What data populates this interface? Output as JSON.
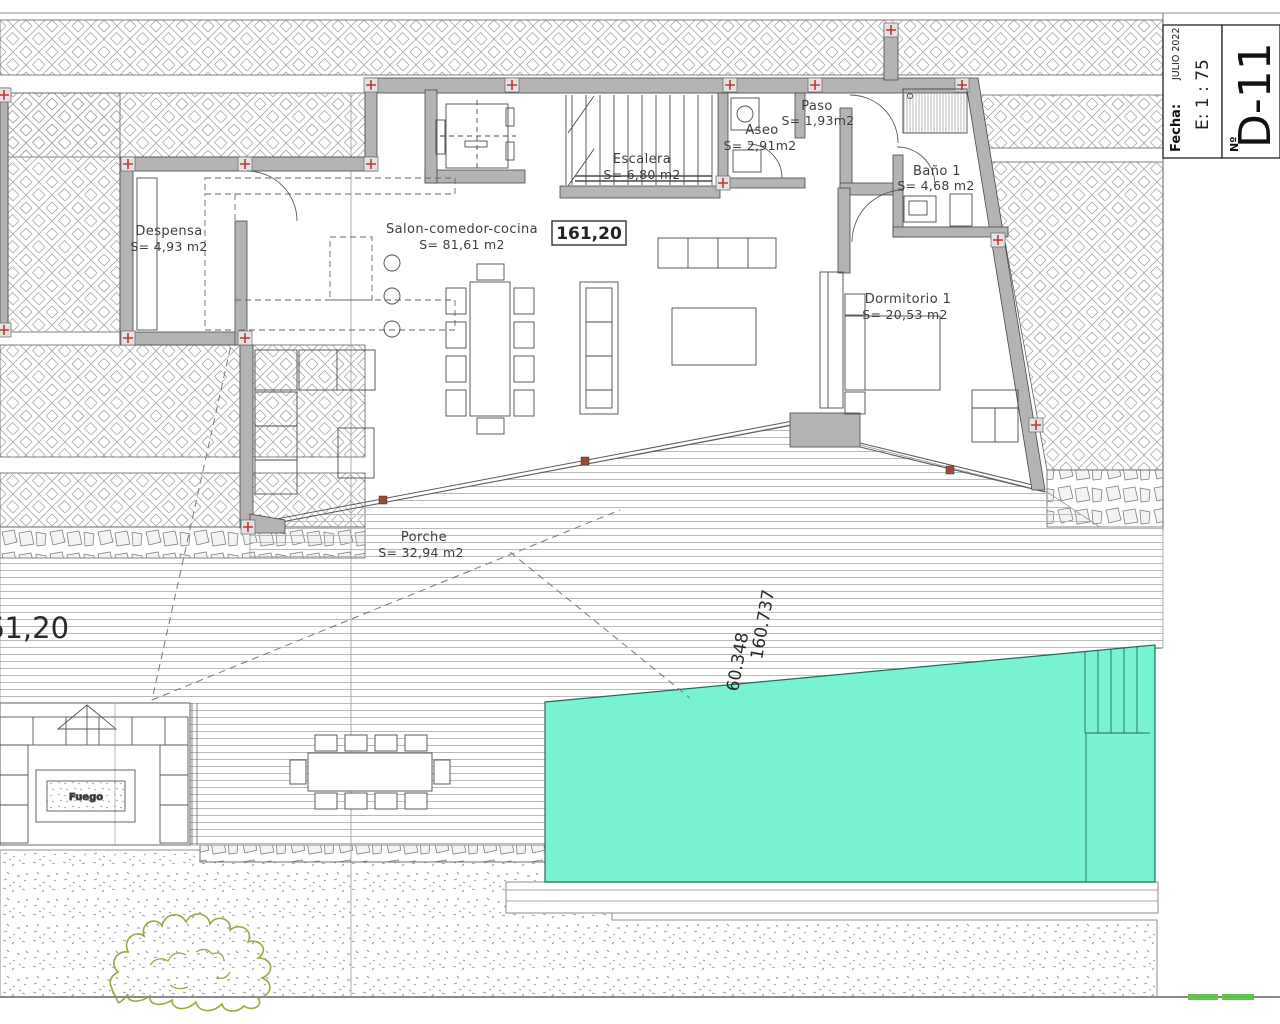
{
  "title_block": {
    "fecha_label": "Fecha:",
    "fecha_value": "JULIO 2022",
    "scale": "E: 1 : 75",
    "number_label": "Nº",
    "sheet_number": "D-11"
  },
  "rooms": {
    "despensa": {
      "name": "Despensa",
      "area": "S= 4,93 m2"
    },
    "salon": {
      "name": "Salon-comedor-cocina",
      "area": "S= 81,61 m2"
    },
    "escalera": {
      "name": "Escalera",
      "area": "S= 6,80 m2"
    },
    "aseo": {
      "name": "Aseo",
      "area": "S= 2,91m2"
    },
    "paso": {
      "name": "Paso",
      "area": "S= 1,93m2"
    },
    "bano1": {
      "name": "Baño 1",
      "area": "S= 4,68 m2"
    },
    "dormitorio1": {
      "name": "Dormitorio 1",
      "area": "S= 20,53 m2"
    },
    "porche": {
      "name": "Porche",
      "area": "S= 32,94 m2"
    }
  },
  "annotations": {
    "floor_level": "161,20",
    "left_level": "61,20",
    "pool_elev_1": "60.348",
    "pool_elev_2": "160.737",
    "fire_pit": "Fuego"
  },
  "colors": {
    "pool_fill": "#78F3D2",
    "pool_edge": "#1d6e5c",
    "wall_gray": "#b4b4b4",
    "marker_red": "#c0392b",
    "bush_green": "#8fae3f",
    "grass_green": "#62c24e"
  }
}
